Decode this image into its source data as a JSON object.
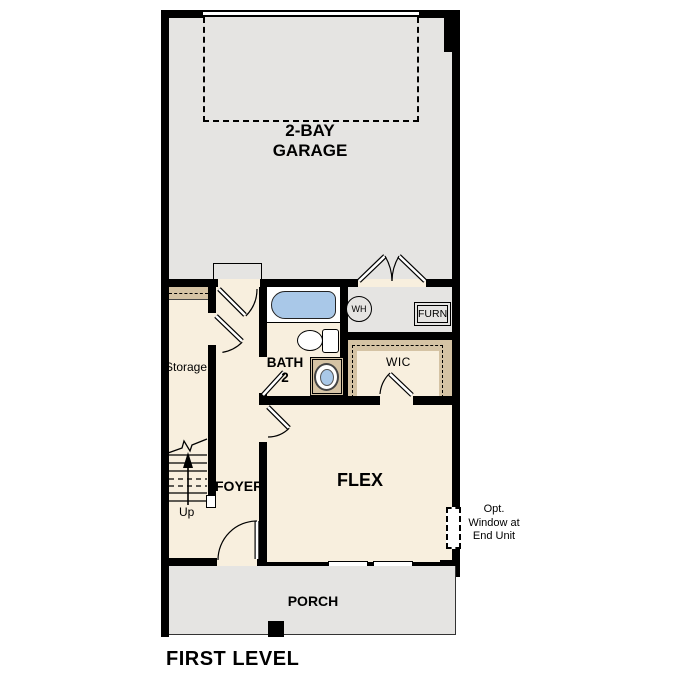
{
  "title": "FIRST LEVEL",
  "colors": {
    "floor_gray": "#e5e4e2",
    "floor_cream": "#f8efde",
    "shelf_tan": "#d5c3a4",
    "fixture_blue": "#a9c8e8",
    "wall_black": "#000000"
  },
  "rooms": {
    "garage": {
      "label_line1": "2-BAY",
      "label_line2": "GARAGE"
    },
    "storage": {
      "label": "Storage"
    },
    "bath": {
      "label_line1": "BATH",
      "label_line2": "2"
    },
    "wic": {
      "label": "WIC"
    },
    "foyer": {
      "label": "FOYER"
    },
    "flex": {
      "label": "FLEX"
    },
    "porch": {
      "label": "PORCH"
    }
  },
  "fixtures": {
    "water_heater_label": "WH",
    "furnace_label": "FURN"
  },
  "stairs": {
    "direction_label": "Up"
  },
  "annotations": {
    "opt_window": {
      "line1": "Opt.",
      "line2": "Window at",
      "line3": "End Unit"
    }
  }
}
